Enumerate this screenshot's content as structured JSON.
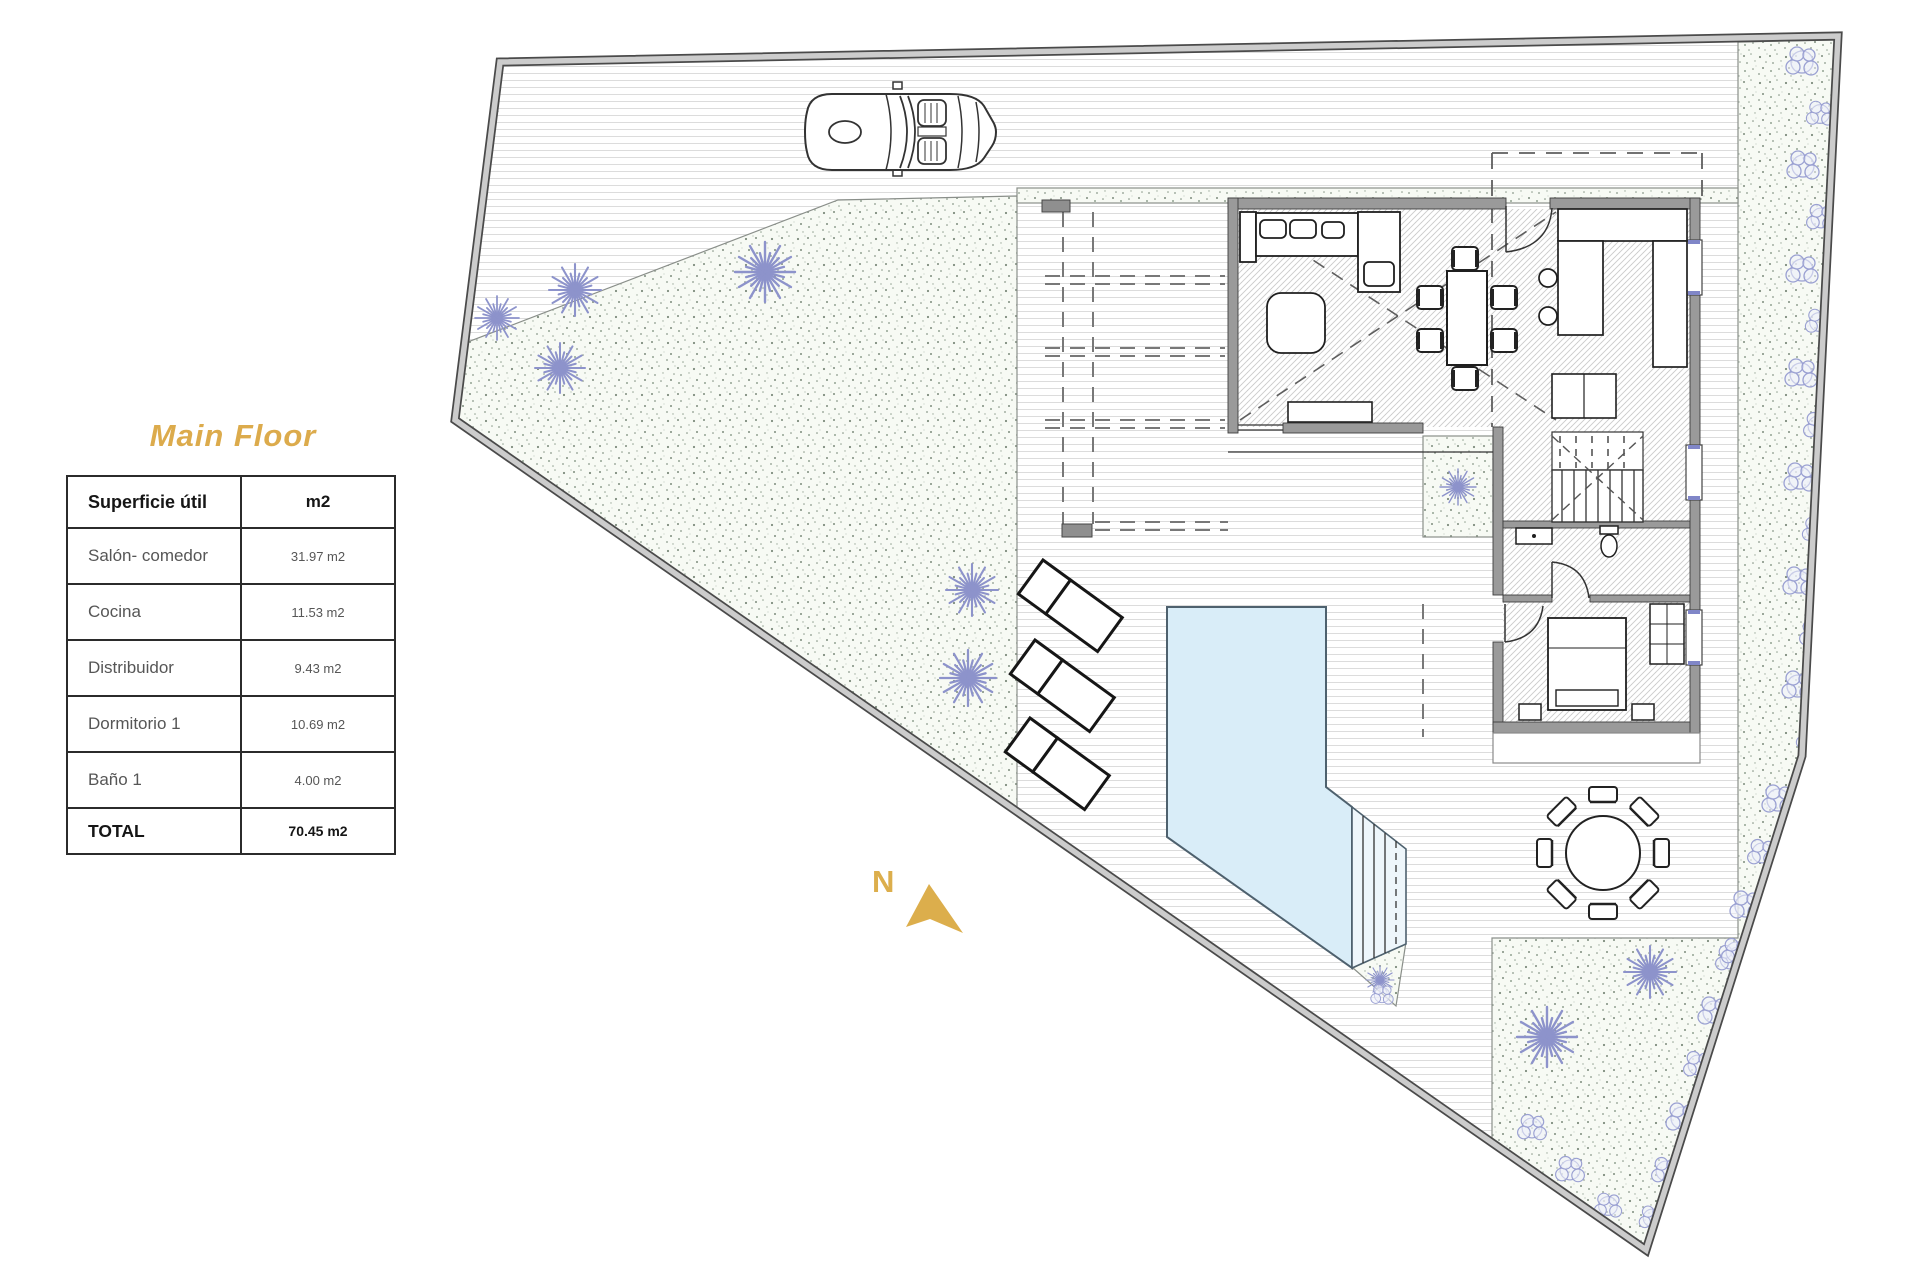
{
  "title": {
    "text": "Main Floor",
    "color": "#dcab4c"
  },
  "area_table": {
    "header": {
      "label": "Superficie útil",
      "unit": "m2"
    },
    "rows": [
      {
        "label": "Salón- comedor",
        "value": "31.97 m2"
      },
      {
        "label": "Cocina",
        "value": "11.53 m2"
      },
      {
        "label": "Distribuidor",
        "value": "9.43 m2"
      },
      {
        "label": "Dormitorio 1",
        "value": "10.69 m2"
      },
      {
        "label": "Baño 1",
        "value": "4.00 m2"
      }
    ],
    "total": {
      "label": "TOTAL",
      "value": "70.45 m2"
    }
  },
  "compass": {
    "label": "N",
    "color": "#dcae4c"
  },
  "plan": {
    "icons": [
      "car-icon",
      "north-arrow-icon",
      "pool",
      "sun-lounger-icon",
      "outdoor-table-icon",
      "plant-icon",
      "shrub-icon",
      "bed-icon",
      "sofa-icon",
      "dining-table-icon",
      "stairs-icon",
      "toilet-icon",
      "sink-icon"
    ],
    "colors": {
      "pool_water": "#d9edf8",
      "wall_gray": "#9a9a9a",
      "garden_speckle": "#7d8c7d",
      "plant_purple": "#8d93cb",
      "accent_gold": "#dcab4c",
      "deck_line": "#dcdcdc"
    }
  }
}
